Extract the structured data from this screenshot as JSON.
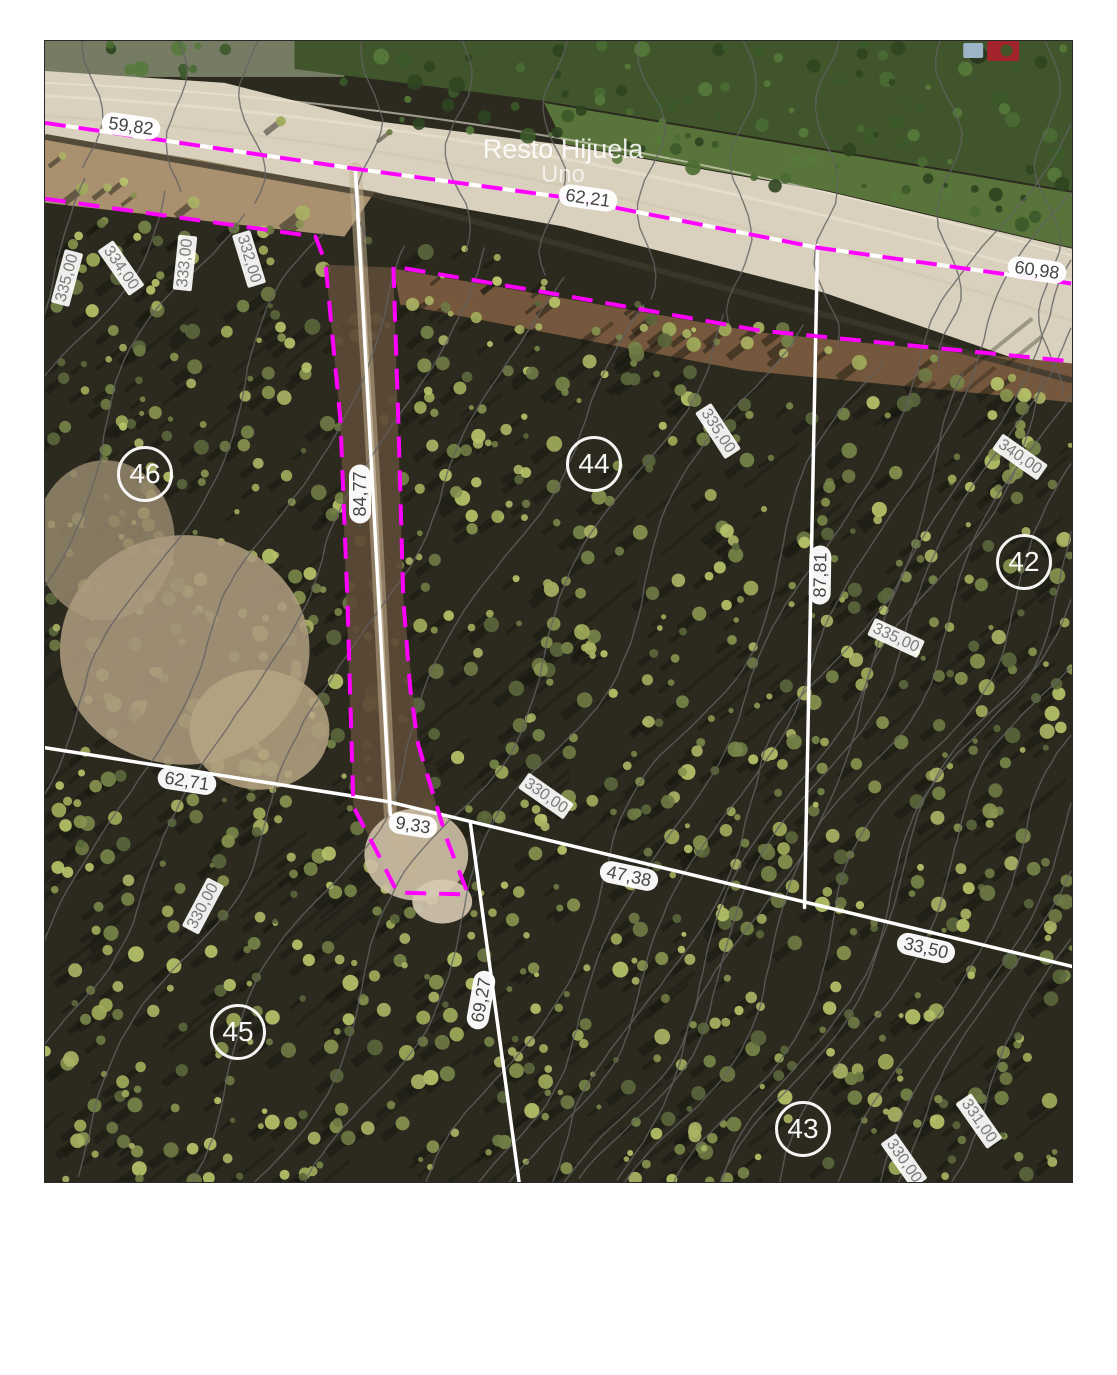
{
  "map": {
    "title_hint": "Cadastral subdivision plan over aerial photo",
    "area_label": {
      "line1": "Resto Hijuela",
      "line2": "Uno"
    },
    "parcels": [
      {
        "number": "46",
        "x": 100,
        "y": 433
      },
      {
        "number": "44",
        "x": 549,
        "y": 423
      },
      {
        "number": "42",
        "x": 979,
        "y": 521
      },
      {
        "number": "45",
        "x": 193,
        "y": 991
      },
      {
        "number": "43",
        "x": 758,
        "y": 1088
      }
    ],
    "measurements": [
      {
        "text": "59,82",
        "x": 86,
        "y": 85,
        "rot": 8
      },
      {
        "text": "62,21",
        "x": 543,
        "y": 157,
        "rot": 8
      },
      {
        "text": "60,98",
        "x": 992,
        "y": 229,
        "rot": 8
      },
      {
        "text": "84,77",
        "x": 315,
        "y": 453,
        "rot": -90
      },
      {
        "text": "87,81",
        "x": 775,
        "y": 534,
        "rot": -89
      },
      {
        "text": "62,71",
        "x": 142,
        "y": 740,
        "rot": 9
      },
      {
        "text": "9,33",
        "x": 368,
        "y": 784,
        "rot": 9
      },
      {
        "text": "47,38",
        "x": 584,
        "y": 835,
        "rot": 12
      },
      {
        "text": "33,50",
        "x": 881,
        "y": 907,
        "rot": 13
      },
      {
        "text": "69,27",
        "x": 436,
        "y": 959,
        "rot": -80
      }
    ],
    "contour_labels": [
      {
        "text": "335,00",
        "x": 22,
        "y": 237,
        "rot": -75
      },
      {
        "text": "334,00",
        "x": 76,
        "y": 227,
        "rot": 55
      },
      {
        "text": "333,00",
        "x": 140,
        "y": 222,
        "rot": -84
      },
      {
        "text": "332,00",
        "x": 204,
        "y": 218,
        "rot": 73
      },
      {
        "text": "335,00",
        "x": 673,
        "y": 390,
        "rot": 57
      },
      {
        "text": "340,00",
        "x": 975,
        "y": 416,
        "rot": 35
      },
      {
        "text": "335,00",
        "x": 851,
        "y": 597,
        "rot": 25
      },
      {
        "text": "330,00",
        "x": 501,
        "y": 755,
        "rot": 35
      },
      {
        "text": "330,00",
        "x": 158,
        "y": 865,
        "rot": -62
      },
      {
        "text": "331,00",
        "x": 934,
        "y": 1080,
        "rot": 55
      },
      {
        "text": "330,00",
        "x": 859,
        "y": 1120,
        "rot": 55
      }
    ],
    "colors": {
      "subdivision_boundary_magenta": "#ff00ff",
      "parcel_boundary_white": "#ffffff",
      "contour_line_gray": "#616161",
      "road_surface": "#d9d0bd",
      "measurement_text": "#454545",
      "contour_label_text": "#7a7a7a",
      "parcel_number_text": "#ffffff"
    }
  }
}
